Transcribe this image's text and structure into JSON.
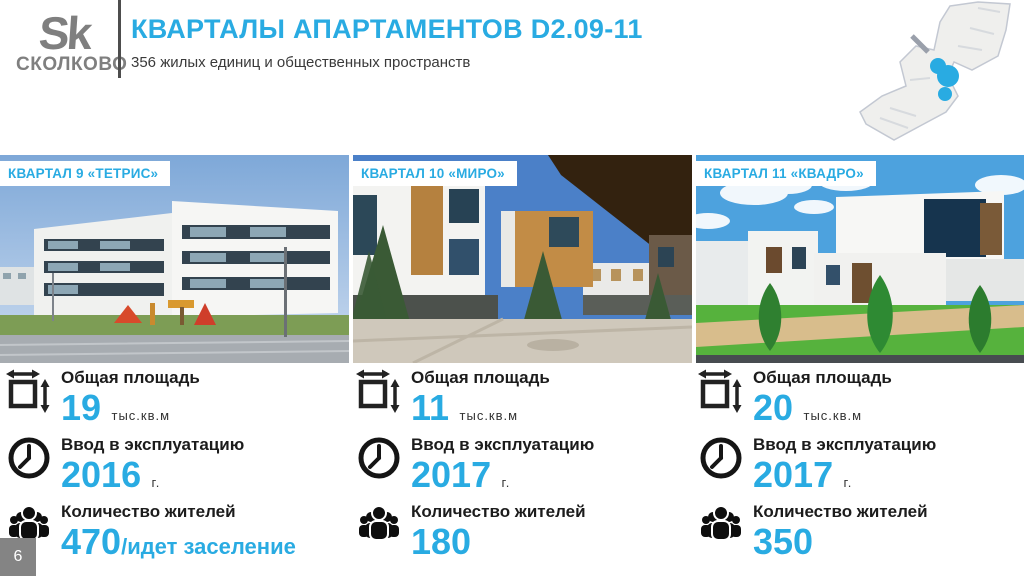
{
  "slide": {
    "logo_mark": "Sk",
    "logo_name": "СКОЛКОВО",
    "title": "КВАРТАЛЫ АПАРТАМЕНТОВ D2.09-11",
    "subtitle": "356 жилых единиц и общественных пространств",
    "page_number": "6"
  },
  "stat_labels": {
    "area": "Общая площадь",
    "commissioning": "Ввод в эксплуатацию",
    "residents": "Количество жителей"
  },
  "quarters": [
    {
      "label": "КВАРТАЛ 9 «ТЕТРИС»",
      "area_value": "19",
      "area_unit": "тыс.кв.м",
      "year_value": "2016",
      "year_unit": "г.",
      "residents_value": "470",
      "residents_note": "/идет заселение"
    },
    {
      "label": "КВАРТАЛ 10 «МИРО»",
      "area_value": "11",
      "area_unit": "тыс.кв.м",
      "year_value": "2017",
      "year_unit": "г.",
      "residents_value": "180",
      "residents_note": ""
    },
    {
      "label": "КВАРТАЛ 11  «КВАДРО»",
      "area_value": "20",
      "area_unit": "тыс.кв.м",
      "year_value": "2017",
      "year_unit": "г.",
      "residents_value": "350",
      "residents_note": ""
    }
  ],
  "icons": {
    "area": "area-resize-icon",
    "commissioning": "clock-icon",
    "residents": "people-group-icon",
    "map": "skolkovo-map-locator"
  },
  "colors": {
    "accent": "#29abe2",
    "text_dark": "#1c1c1c",
    "logo_gray": "#7f7f7f"
  }
}
